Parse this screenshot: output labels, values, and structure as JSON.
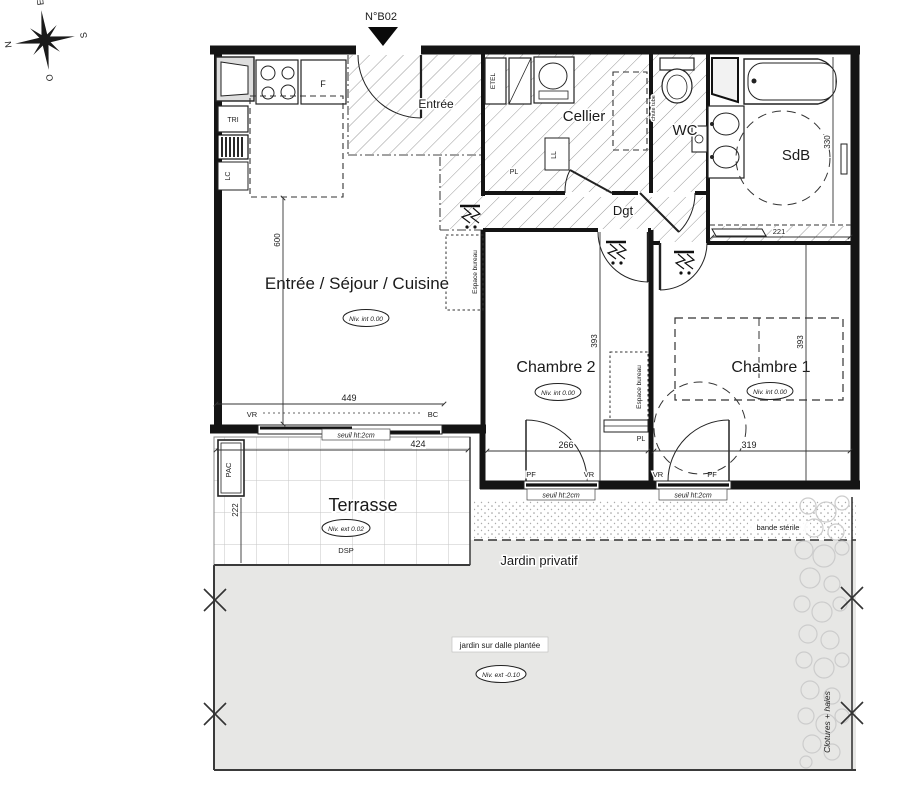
{
  "plan_number": "N°B02",
  "compass": {
    "n": "N",
    "e": "E",
    "s": "S",
    "o": "O"
  },
  "rooms": {
    "sejour": {
      "name": "Entrée / Séjour / Cuisine",
      "level": "Niv. int 0.00"
    },
    "entree": {
      "name": "Entrée"
    },
    "cellier": {
      "name": "Cellier"
    },
    "wc": {
      "name": "WC"
    },
    "sdb": {
      "name": "SdB"
    },
    "dgt": {
      "name": "Dgt"
    },
    "chambre2": {
      "name": "Chambre 2",
      "level": "Niv. int 0.00"
    },
    "chambre1": {
      "name": "Chambre 1",
      "level": "Niv. int 0.00"
    },
    "terrasse": {
      "name": "Terrasse",
      "level": "Niv. ext 0.02",
      "note": "DSP"
    },
    "jardin": {
      "name": "Jardin privatif",
      "note": "jardin sur dalle plantée",
      "level": "Niv. ext -0.10"
    }
  },
  "equipment": {
    "fridge": "F",
    "tri": "TRI",
    "lc": "LC",
    "etel": "ETEL",
    "ll": "LL",
    "pl_cellier": "PL",
    "pl_chambre": "PL",
    "pac": "PAC",
    "chute": "chute tube",
    "espace_bureau_sejour": "Espace bureau",
    "espace_bureau_chambre": "Espace bureau"
  },
  "openings": {
    "sejour_bay": {
      "left": "VR",
      "right": "BC",
      "seuil": "seuil ht:2cm"
    },
    "chambre2_window": {
      "left": "PF",
      "right": "VR",
      "seuil": "seuil ht:2cm"
    },
    "chambre1_window": {
      "left": "VR",
      "right": "PF",
      "seuil": "seuil ht:2cm"
    }
  },
  "dimensions": {
    "sejour_depth": "600",
    "bay_width": "449",
    "terrasse_width": "424",
    "terrasse_depth": "222",
    "chambre2_width": "266",
    "chambre2_depth": "393",
    "chambre1_width": "319",
    "chambre1_depth": "393",
    "sdb_depth": "330",
    "dressing_width": "221"
  },
  "site": {
    "bande_sterile": "bande stérile",
    "clotures": "Clotures + haies"
  }
}
